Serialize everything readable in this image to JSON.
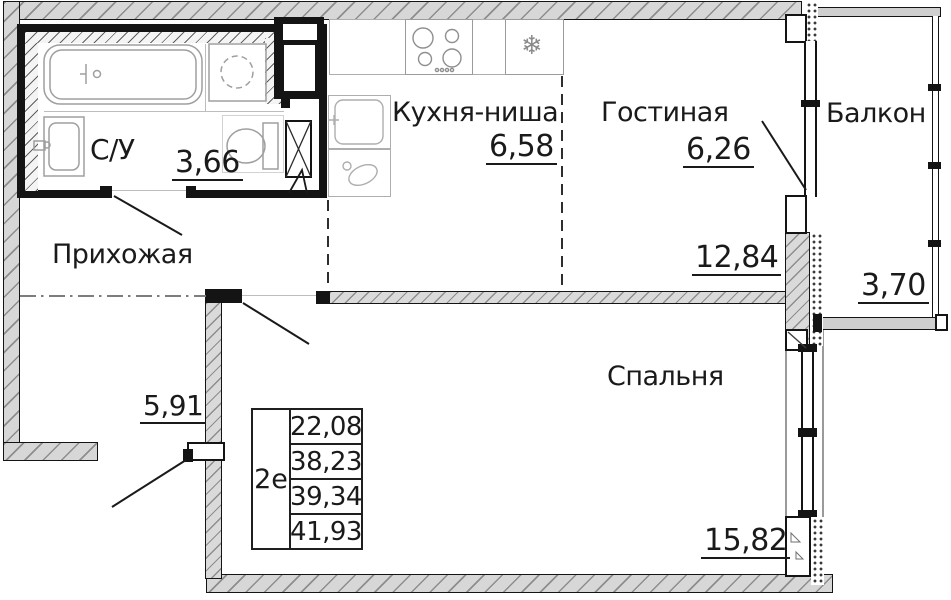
{
  "rooms": {
    "bathroom": {
      "label": "С/У",
      "area": "3,66"
    },
    "hallway": {
      "label": "Прихожая",
      "area": "5,91"
    },
    "kitchen": {
      "label": "Кухня-ниша",
      "area": "6,58"
    },
    "living": {
      "label": "Гостиная",
      "area": "6,26",
      "combined_area": "12,84"
    },
    "bedroom": {
      "label": "Спальня",
      "area": "15,82"
    },
    "balcony": {
      "label": "Балкон",
      "area": "3,70"
    }
  },
  "info_table": {
    "unit_type": "2е",
    "values": [
      "22,08",
      "38,23",
      "39,34",
      "41,93"
    ]
  },
  "icons": {
    "fridge": "❄"
  },
  "colors": {
    "line": "#141414",
    "fixture": "#9f9f9f",
    "wall_fill": "#d7d7d7"
  }
}
